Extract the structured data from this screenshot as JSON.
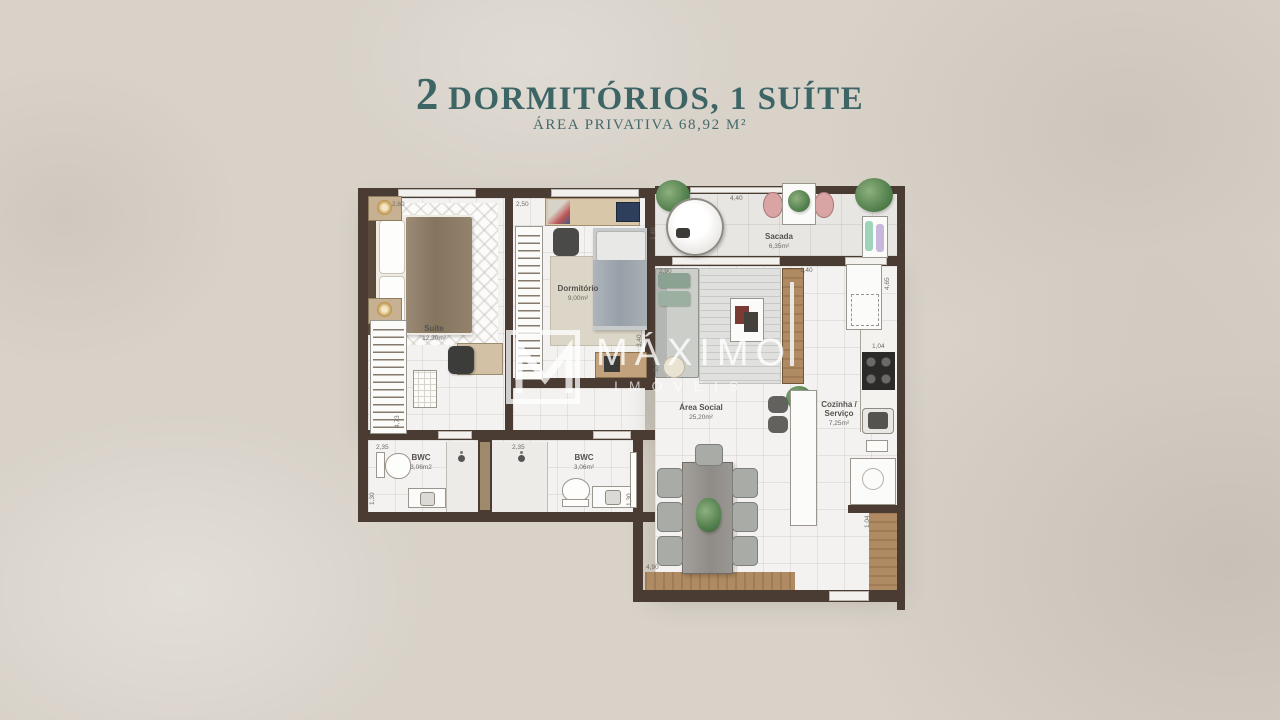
{
  "header": {
    "title_number": "2",
    "title_text": " DORMITÓRIOS, 1 SUÍTE",
    "subtitle": "ÁREA PRIVATIVA 68,92 M²"
  },
  "watermark": {
    "brand": "MÁXIMO",
    "brand_sub": "IMÓVEIS"
  },
  "rooms": {
    "suite": {
      "label": "Suíte",
      "area": "12,30m²"
    },
    "dormitorio": {
      "label": "Dormitório",
      "area": "9,00m²"
    },
    "sacada": {
      "label": "Sacada",
      "area": "6,35m²"
    },
    "area_social": {
      "label": "Área Social",
      "area": "25,20m²"
    },
    "cozinha": {
      "label_line1": "Cozinha /",
      "label_line2": "Serviço",
      "area": "7,25m²"
    },
    "bwc1": {
      "label": "BWC",
      "area": "3,06m2"
    },
    "bwc2": {
      "label": "BWC",
      "area": "3,06m²"
    }
  },
  "dimensions": {
    "suite_width": "2,60",
    "dorm_width": "2,50",
    "sacada_width": "4,40",
    "sacada_depth": "1,40",
    "living_width": "2,90",
    "hall_width": "1,40",
    "kitchen_height": "4,65",
    "counter_width": "1,04",
    "dorm_height": "3,40",
    "living_height": "3,45",
    "suite_height": "4,73",
    "bwc1_width": "2,35",
    "bwc2_width": "2,35",
    "bwc1_depth": "1,30",
    "bwc2_depth": "1,30",
    "dining_width": "4,90",
    "deck_width": "1,04"
  },
  "colors": {
    "accent_teal": "#3e6566",
    "wall": "#4a3c33",
    "wood": "#b08a62"
  }
}
